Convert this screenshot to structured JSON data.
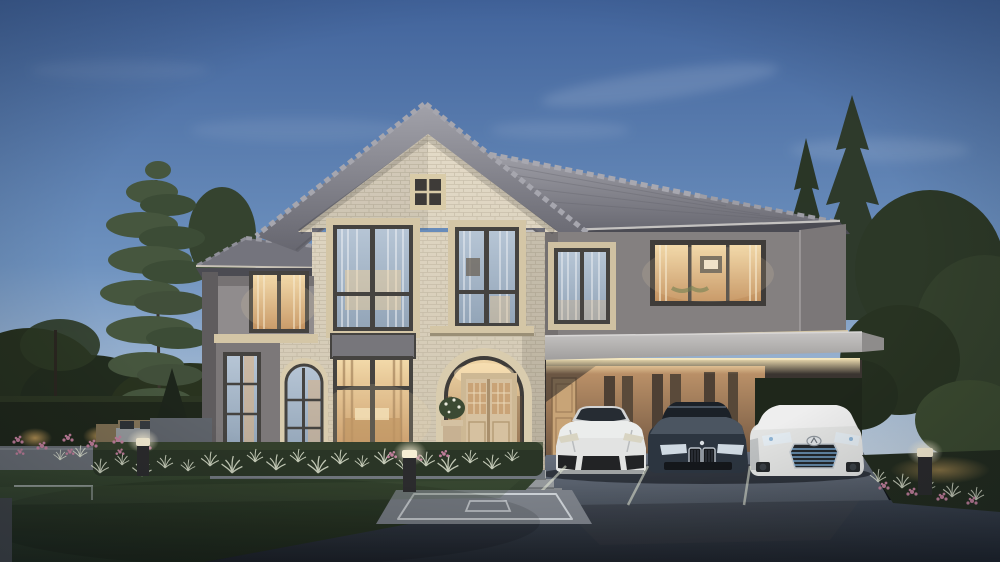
{
  "meta": {
    "type": "architectural-exterior-rendering",
    "time_of_day": "dusk",
    "description": "Photorealistic dusk rendering of a two-story luxury house with cream brick gable bay, gray stucco wings, arched entry portico, carport with three parked cars, landscaped garden, hedges with uplights and bollard path lights"
  },
  "scene": {
    "house": {
      "stories": 2,
      "facade": "cream brick bay with warm-gray stucco wings",
      "roof": "gray concrete tile; front gable over brick bay, hip roof over right wing, small hip over left wing",
      "entrance": "arched brick portico with glazed tan double door, potted plant, three concrete steps",
      "windows": "dark bronze frames, cream surrounds, white curtains, warm interior lighting"
    },
    "carport": {
      "position": "right",
      "lighting": "warm cove lighting under flat fascia",
      "cars": [
        {
          "type": "sports-car",
          "color_name": "white"
        },
        {
          "type": "sedan",
          "color_name": "dark blue-gray",
          "grille": "twin chrome kidney"
        },
        {
          "type": "crossover-suv",
          "color_name": "white",
          "grille": "blue-lit spindle with badge"
        }
      ]
    },
    "landscape": {
      "foreground": "dark lawn and asphalt driveway with paver apron and white stall lines",
      "hedges": "clipped dark hedge walls left and right with warm uplights",
      "trees": [
        "tall pine left",
        "second pine",
        "two spruces right",
        "broadleaf background masses"
      ],
      "flowers": "pink beds left, mid and along right hedge",
      "grasses": "white-tipped ornamental grass band in raised planter",
      "patio": "outdoor lounge set on pavers at left"
    },
    "lights": {
      "bollards": 3,
      "hedge_uplights": true,
      "interior_glow": true,
      "carport_cove": true
    }
  },
  "colors": {
    "sky_top": "#41639b",
    "sky_mid": "#6e92bf",
    "sky_horizon": "#c9d6e2",
    "hedge": "#1f271b",
    "uplight": "#c9a05c",
    "roof_light": "#a2a2aa",
    "roof_dark": "#66666f",
    "brick_light": "#e4dbc8",
    "brick_shade": "#cdc3ae",
    "trim_cream": "#d4c6a6",
    "stucco": "#908c8d",
    "frame_dark": "#454340",
    "door_tan": "#d6c1a0",
    "porch_warm_top": "#f0d6a6",
    "porch_warm_bottom": "#a97f58",
    "carport_wall": "#c0956b",
    "carport_wall_shadow": "#6e543f",
    "cove_glow": "#ffedbd",
    "car_white": "#e2e3e2",
    "car_blue": "#2c3540",
    "lexus_grille_blue": "#7fb2dd",
    "asphalt_light": "#3a424e",
    "asphalt_dark": "#1e232b",
    "lawn_light": "#35452f",
    "lawn_dark": "#1e281c",
    "flower_pink": "#bf7e9a",
    "grass_tip": "#e9edda",
    "bollard_glow": "#f7eed4"
  }
}
